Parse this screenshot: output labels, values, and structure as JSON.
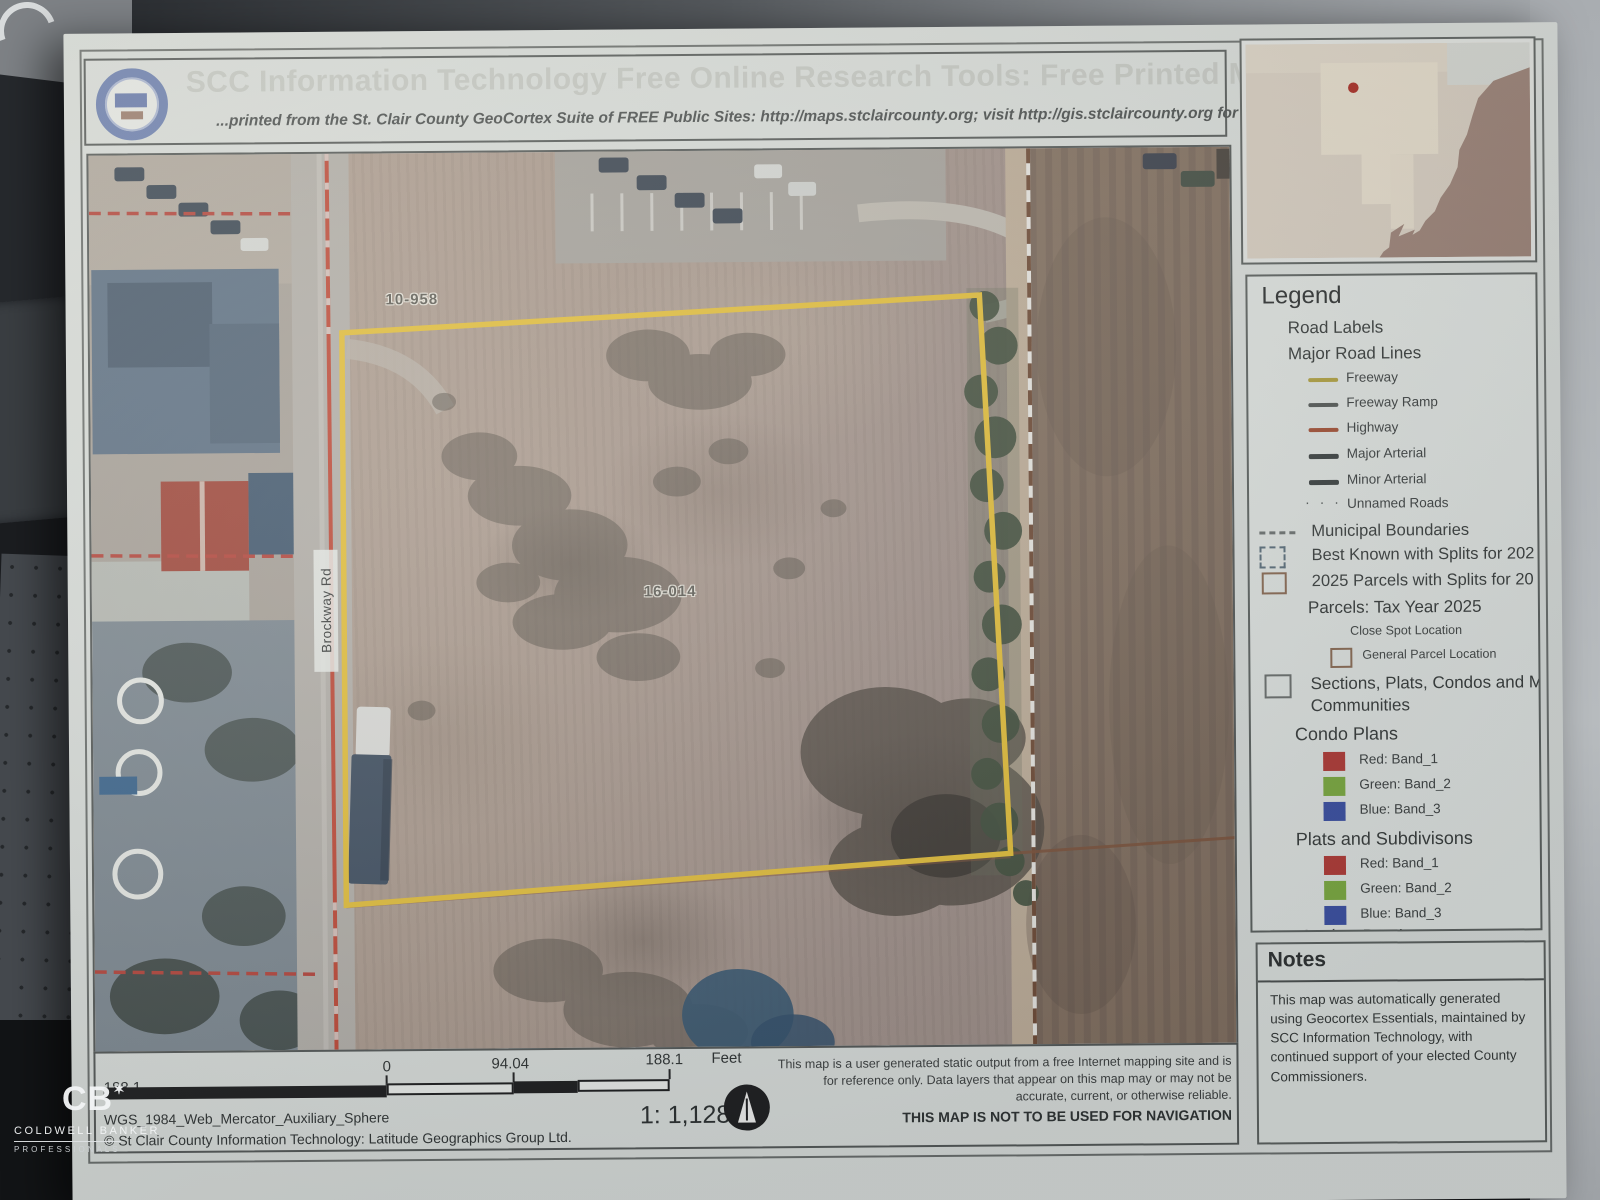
{
  "header": {
    "title": "SCC Information Technology Free Online Research Tools: Free Printed Map",
    "subtitle": "...printed from the St. Clair County GeoCortex Suite of FREE Public Sites: http://maps.stclaircounty.org; visit http://gis.stclaircounty.org for details."
  },
  "map": {
    "labels": {
      "parcel_top": "10-958",
      "parcel_main": "16-014",
      "road": "Brockway Rd"
    },
    "parcel_outline_color": "#e4bf39",
    "highway_line_color": "#c04936"
  },
  "locator": {
    "marker_color": "#a8291f"
  },
  "legend": {
    "heading": "Legend",
    "items": [
      {
        "kind": "subheading",
        "label": "Road Labels"
      },
      {
        "kind": "subheading",
        "label": "Major Road Lines"
      },
      {
        "kind": "line",
        "label": "Freeway",
        "color": "#b0a03e"
      },
      {
        "kind": "line",
        "label": "Freeway Ramp",
        "color": "#545855"
      },
      {
        "kind": "line",
        "label": "Highway",
        "color": "#a34f33"
      },
      {
        "kind": "line",
        "label": "Major Arterial",
        "color": "#3c4140"
      },
      {
        "kind": "line",
        "label": "Minor Arterial",
        "color": "#3c4140"
      },
      {
        "kind": "dots",
        "label": "Unnamed Roads"
      },
      {
        "kind": "dashes",
        "label": "Municipal Boundaries"
      },
      {
        "kind": "dashed-box",
        "label": "Best Known with Splits for 202"
      },
      {
        "kind": "box",
        "label": "2025 Parcels with Splits for 20"
      },
      {
        "kind": "subheading",
        "label": "Parcels: Tax Year 2025"
      },
      {
        "kind": "plain-small",
        "label": "Close Spot Location"
      },
      {
        "kind": "box-small",
        "label": "General Parcel Location"
      },
      {
        "kind": "box-big",
        "label": "Sections, Plats, Condos and M",
        "label2": "Communities"
      },
      {
        "kind": "subheading",
        "label": "Condo Plans"
      },
      {
        "kind": "swatch",
        "label": "Red:  Band_1",
        "color": "#b23b35"
      },
      {
        "kind": "swatch",
        "label": "Green: Band_2",
        "color": "#7dab3f"
      },
      {
        "kind": "swatch",
        "label": "Blue:  Band_3",
        "color": "#3c50a2"
      },
      {
        "kind": "subheading",
        "label": "Plats and Subdivisons"
      },
      {
        "kind": "swatch",
        "label": "Red:  Band_1",
        "color": "#b23b35"
      },
      {
        "kind": "swatch",
        "label": "Green: Band_2",
        "color": "#7dab3f"
      },
      {
        "kind": "swatch",
        "label": "Blue:  Band_3",
        "color": "#3c50a2"
      },
      {
        "kind": "subheading",
        "label": "Anchor Bay Lots"
      }
    ]
  },
  "notes": {
    "heading": "Notes",
    "body": "This map was automatically generated using Geocortex Essentials, maintained by SCC Information Technology, with continued support of your elected County Commissioners."
  },
  "footer": {
    "scale": {
      "left": "188.1",
      "zero": "0",
      "mid": "94.04",
      "right": "188.1",
      "unit": "Feet"
    },
    "projection": "WGS_1984_Web_Mercator_Auxiliary_Sphere",
    "copyright": "© St Clair County Information Technology: Latitude Geographics Group Ltd.",
    "ratio": "1: 1,128",
    "disclaimer": "This map is a user generated static output from a free Internet mapping site and is for reference only. Data layers that appear on this map may or may not be accurate, current, or otherwise reliable.",
    "warning": "THIS MAP IS NOT TO BE USED FOR NAVIGATION"
  },
  "watermark": {
    "logo": "CB",
    "star": "✶",
    "line1": "COLDWELL BANKER",
    "line2": "PROFESSIONALS"
  }
}
